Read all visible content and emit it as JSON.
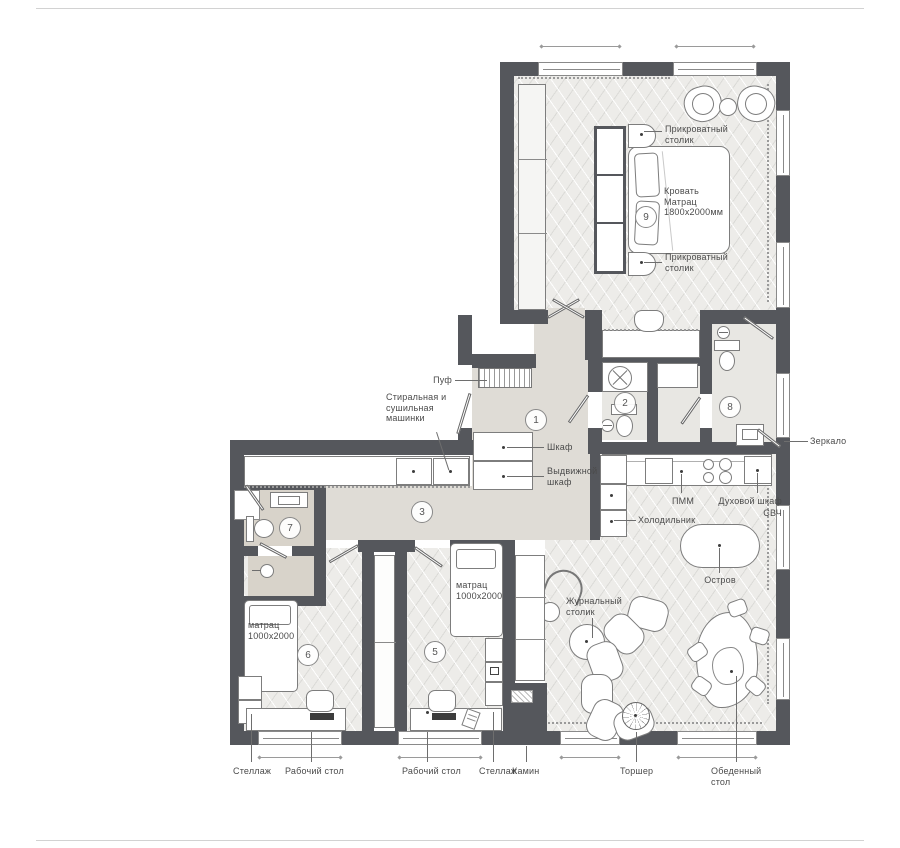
{
  "rooms": {
    "n1": "1",
    "n2": "2",
    "n3": "3",
    "n5": "5",
    "n6": "6",
    "n7": "7",
    "n8": "8",
    "n9": "9"
  },
  "bedroom": {
    "bed": "Кровать\nМатрац\n1800х2000мм",
    "nightstand_top": "Прикроватный\nстолик",
    "nightstand_bottom": "Прикроватный\nстолик"
  },
  "hall": {
    "pouf": "Пуф",
    "wardrobe": "Шкаф",
    "pullout_wardrobe": "Выдвижной\nшкаф",
    "laundry": "Стиральная и\nсушильная\nмашинки"
  },
  "kitchen": {
    "dishwasher": "ПММ",
    "oven": "Духовой шкаф",
    "microwave": "СВЧ",
    "fridge": "Холодильник",
    "island": "Остров"
  },
  "living": {
    "coffee_table": "Журнальный\nстолик",
    "floor_lamp": "Торшер",
    "dining_table": "Обеденный\nстол"
  },
  "bathroom": {
    "mirror": "Зеркало"
  },
  "kids": {
    "mattress_left": "матрац\n1000х2000",
    "mattress_right": "матрац\n1000х2000"
  },
  "bottom": {
    "shelf_left": "Стеллаж",
    "desk_left": "Рабочий стол",
    "desk_right": "Рабочий стол",
    "shelf_right": "Стеллаж",
    "fireplace": "Камин"
  }
}
